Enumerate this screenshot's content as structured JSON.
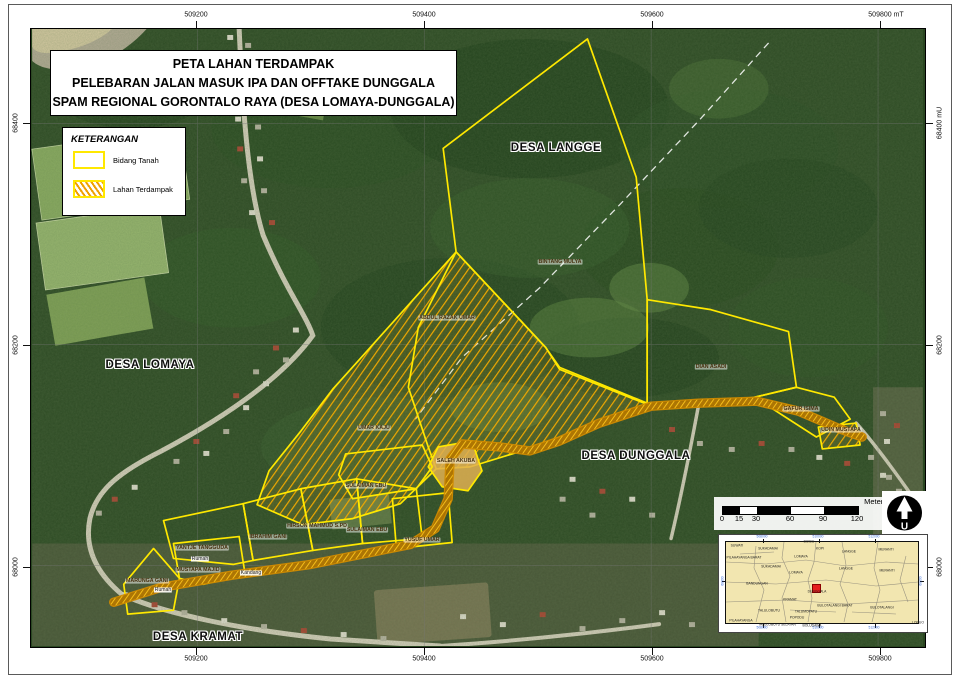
{
  "title_block": {
    "line1": "PETA LAHAN TERDAMPAK",
    "line2": "PELEBARAN JALAN MASUK IPA DAN OFFTAKE DUNGGALA",
    "line3": "SPAM REGIONAL GORONTALO RAYA (DESA LOMAYA-DUNGGALA)"
  },
  "legend": {
    "title": "KETERANGAN",
    "items": [
      {
        "label": "Bidang Tanah",
        "swatch": "yellow-outline"
      },
      {
        "label": "Lahan Terdampak",
        "swatch": "orange-hatch"
      }
    ]
  },
  "axes": {
    "top": [
      "509200",
      "509400",
      "509600",
      "509800 mT"
    ],
    "bottom": [
      "509200",
      "509400",
      "509600",
      "509800"
    ],
    "left": [
      "68400",
      "68200",
      "68000"
    ],
    "right": [
      "68400 mU",
      "68200",
      "68000"
    ]
  },
  "villages": [
    {
      "name": "DESA LANGGE"
    },
    {
      "name": "DESA LOMAYA"
    },
    {
      "name": "DESA DUNGGALA"
    },
    {
      "name": "DESA KRAMAT"
    }
  ],
  "parcels": [
    {
      "name": "BINTANG MULYA"
    },
    {
      "name": "ABDUL RAZAK UMAR"
    },
    {
      "name": "UMAR KAJU"
    },
    {
      "name": "SALEH AKUBA"
    },
    {
      "name": "SULAIMAN EBU"
    },
    {
      "name": "SULAIMAN EBU"
    },
    {
      "name": "HIRSON MAHMUD S.PD"
    },
    {
      "name": "IBRAHIM GANI"
    },
    {
      "name": "YANTJE TANGGUDA"
    },
    {
      "name": "YUSUF UMAR"
    },
    {
      "name": "MUSTAPA MAJID"
    },
    {
      "name": "MARUNGA GANI"
    },
    {
      "name": "DIAN ASADI"
    },
    {
      "name": "GAFUR ISIMA"
    },
    {
      "name": "UDIN MUSTAPA"
    }
  ],
  "structures": [
    {
      "name": "Rumah"
    },
    {
      "name": "Kandang"
    },
    {
      "name": "Rumah"
    }
  ],
  "scalebar": {
    "unit": "Meters",
    "ticks": [
      "0",
      "15",
      "30",
      "60",
      "90",
      "120"
    ]
  },
  "north_arrow": {
    "letter": "U"
  },
  "inset": {
    "regions": [
      "SUWATI",
      "SUKADAMAI",
      "BOIDU",
      "KOPI",
      "LANGGE",
      "MERANTI",
      "PILAHAYANGA BARAT",
      "LOMAYA",
      "SUKADAMAI",
      "LOMAYA",
      "LANGGE",
      "MERANTI",
      "BANDUNGAN",
      "KRAMAT",
      "DUNGGALA",
      "BULOTALANGI BARAT",
      "BULOTALANGI",
      "TALULOBUTU",
      "TALUMOPATU",
      "POPODU",
      "PILAHAYANGA",
      "TALULOBUTU SELATAN",
      "BOLUDAWA",
      "LONUO"
    ],
    "ticks": {
      "top": [
        "508000",
        "510000",
        "512000"
      ],
      "bottom": [
        "508000",
        "510000",
        "512000"
      ],
      "left": "68000",
      "right": "68000"
    }
  },
  "colors": {
    "parcel_outline": "#ffe800",
    "hatch": "#f0a000",
    "corridor": "#d08a00",
    "marker": "#e51f1f",
    "inset_bg": "#f2e6b0"
  }
}
